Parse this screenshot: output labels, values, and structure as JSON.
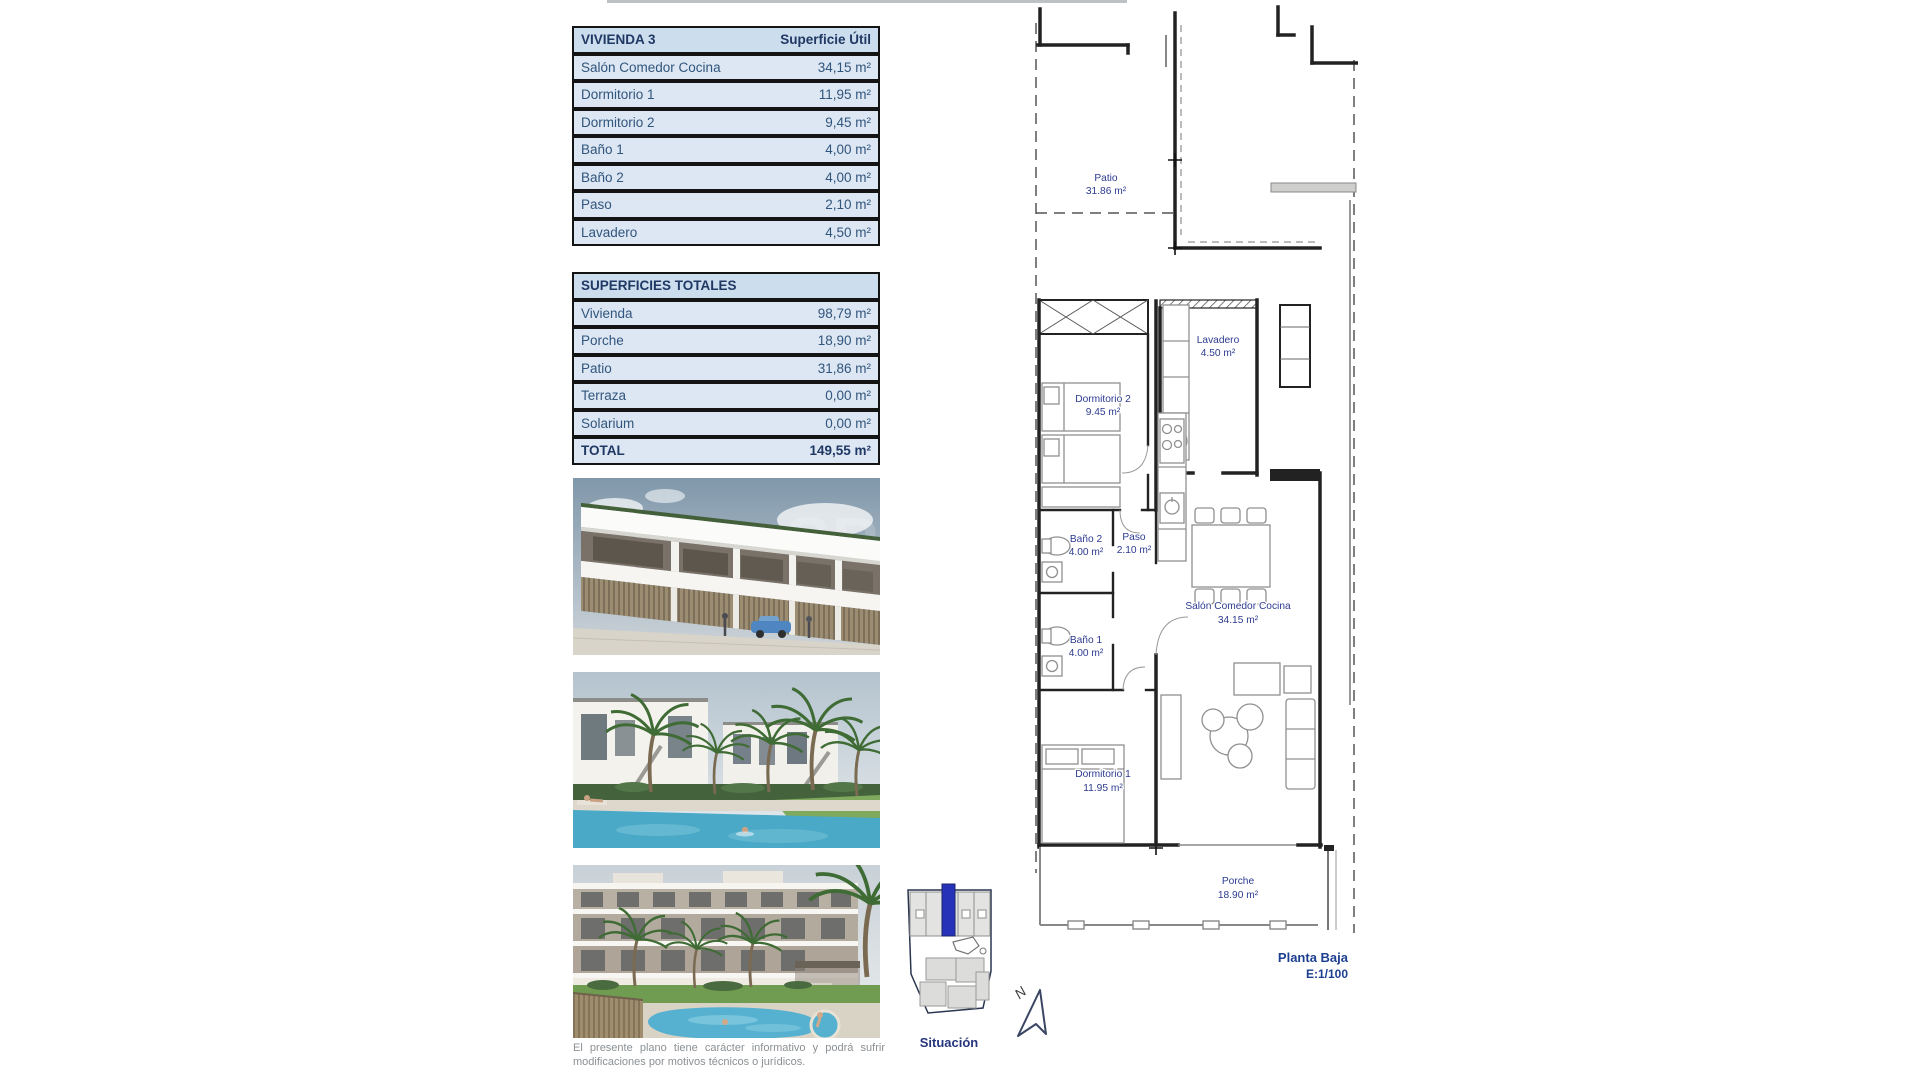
{
  "unit_table": {
    "title": "VIVIENDA 3",
    "title_value": "Superficie Útil",
    "rows": [
      {
        "label": "Salón Comedor Cocina",
        "value": "34,15 m²"
      },
      {
        "label": "Dormitorio 1",
        "value": "11,95 m²"
      },
      {
        "label": "Dormitorio 2",
        "value": "9,45 m²"
      },
      {
        "label": "Baño 1",
        "value": "4,00 m²"
      },
      {
        "label": "Baño 2",
        "value": "4,00 m²"
      },
      {
        "label": "Paso",
        "value": "2,10 m²"
      },
      {
        "label": "Lavadero",
        "value": "4,50 m²"
      }
    ]
  },
  "totals_table": {
    "title": "SUPERFICIES TOTALES",
    "rows": [
      {
        "label": "Vivienda",
        "value": "98,79 m²"
      },
      {
        "label": "Porche",
        "value": "18,90 m²"
      },
      {
        "label": "Patio",
        "value": "31,86 m²"
      },
      {
        "label": "Terraza",
        "value": "0,00 m²"
      },
      {
        "label": "Solarium",
        "value": "0,00 m²"
      }
    ],
    "total": {
      "label": "TOTAL",
      "value": "149,55 m²"
    }
  },
  "floor_plan": {
    "rooms": [
      {
        "name": "Patio",
        "area": "31.86 m²"
      },
      {
        "name": "Lavadero",
        "area": "4.50 m²"
      },
      {
        "name": "Dormitorio 2",
        "area": "9.45 m²"
      },
      {
        "name": "Baño 2",
        "area": "4.00 m²"
      },
      {
        "name": "Paso",
        "area": "2.10 m²"
      },
      {
        "name": "Baño 1",
        "area": "4.00 m²"
      },
      {
        "name": "Salón Comedor Cocina",
        "area": "34.15 m²"
      },
      {
        "name": "Dormitorio 1",
        "area": "11.95 m²"
      },
      {
        "name": "Porche",
        "area": "18.90 m²"
      }
    ],
    "plan_title": "Planta Baja",
    "plan_scale": "E:1/100",
    "north_label": "N"
  },
  "site_map": {
    "label": "Situación"
  },
  "photos": {
    "watermark": "SP"
  },
  "disclaimer": "El presente plano tiene carácter informativo y podrá sufrir modificaciones por motivos técnicos o jurídicos.",
  "colors": {
    "table_header_fill": "#ccdded",
    "table_row_fill": "#dce7f3",
    "table_text": "#31557c",
    "table_title_text": "#1f3864",
    "plan_label_blue": "#2c3a8f",
    "site_highlight_blue": "#2633b8",
    "pool_blue": "#4aa9c6"
  }
}
